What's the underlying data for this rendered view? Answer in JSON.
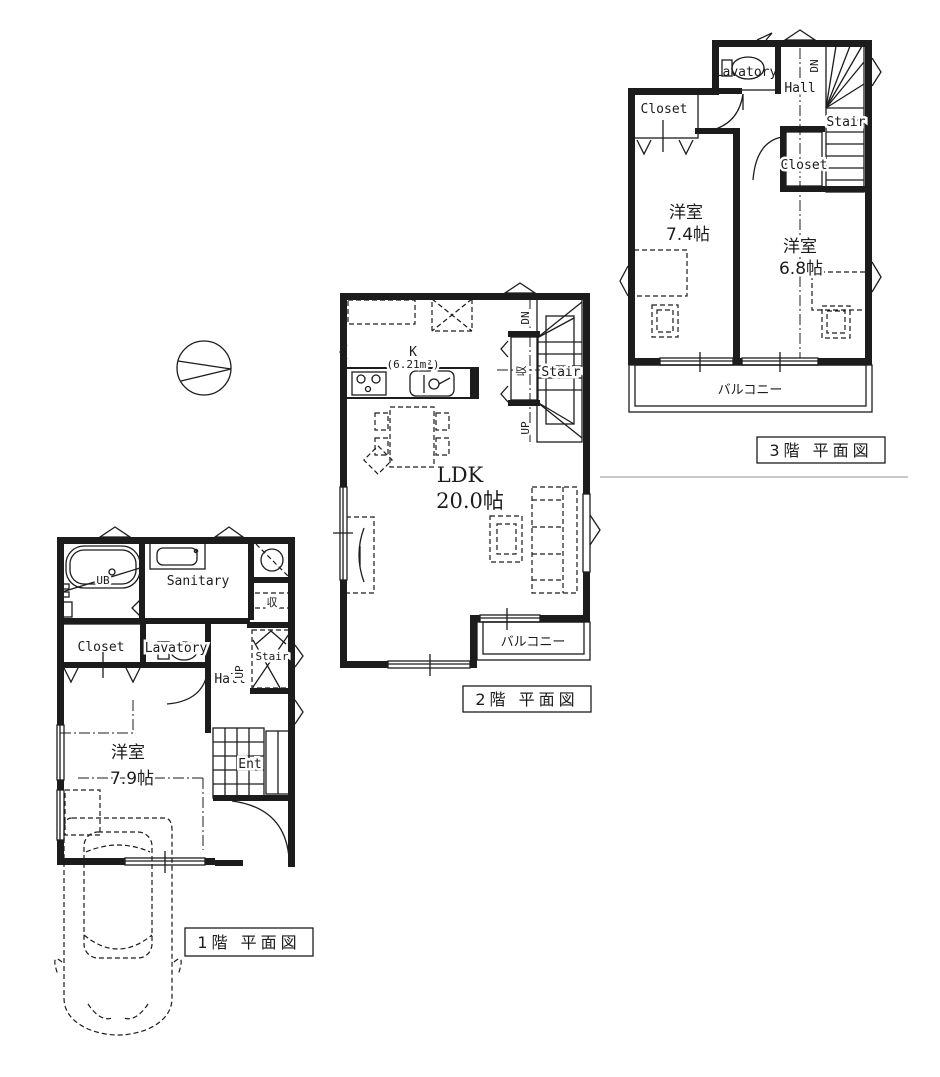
{
  "document": {
    "type": "floor-plan-drawing",
    "colors": {
      "line": "#1c1c1c",
      "background": "#ffffff",
      "faint_divider": "#c9c9c9"
    }
  },
  "compass": {
    "name": "north-indicator-circle"
  },
  "floors": [
    {
      "caption": "1階  平面図",
      "labels": {
        "ub": "UB",
        "sanitary": "Sanitary",
        "storage": "収",
        "closet": "Closet",
        "lavatory": "Lavatory",
        "hall": "Hall",
        "stair": "Stair",
        "up": "UP",
        "bedroom": "洋室",
        "bedroom_size": "7.9帖",
        "entrance": "Ent"
      }
    },
    {
      "caption": "2階  平面図",
      "labels": {
        "kitchen": "K",
        "kitchen_size": "(6.21m²)",
        "ldk": "LDK",
        "ldk_size": "20.0帖",
        "storage": "収",
        "stair": "Stair",
        "dn": "DN",
        "up": "UP",
        "balcony": "バルコニー"
      }
    },
    {
      "caption": "3階  平面図",
      "labels": {
        "lavatory": "Lavatory",
        "hall": "Hall",
        "dn": "DN",
        "stair": "Stair",
        "closet_a": "Closet",
        "closet_b": "Closet",
        "bedroom_a": "洋室",
        "bedroom_a_size": "7.4帖",
        "bedroom_b": "洋室",
        "bedroom_b_size": "6.8帖",
        "balcony": "バルコニー"
      }
    }
  ]
}
